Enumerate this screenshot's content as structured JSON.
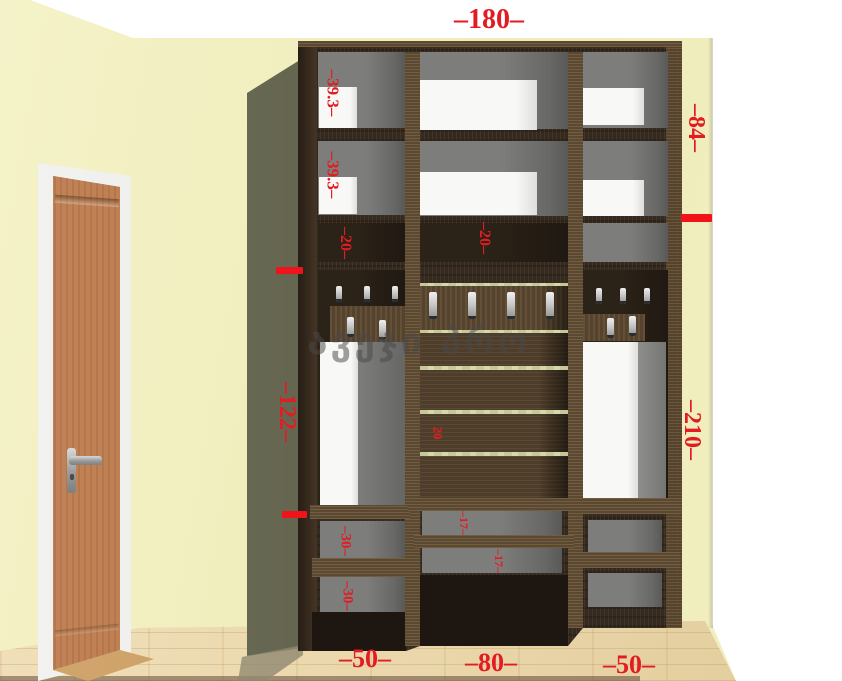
{
  "watermark": {
    "text": "ავეჯი პრო"
  },
  "dimensions": {
    "total_width": "–180–",
    "upper_height": "–84–",
    "right_height": "–210–",
    "left_middle_height": "–122–",
    "left_shelf_top": "–39.3–",
    "left_shelf_second": "–39.3–",
    "left_gap": "–20–",
    "center_gap": "–20–",
    "center_slat_gap": "20",
    "center_shelf_upper": "–17–",
    "center_shelf_lower": "–17–",
    "left_bottom_shelf_upper": "–30–",
    "left_bottom_shelf_lower": "–30–",
    "bottom_left_width": "–50–",
    "bottom_center_width": "–80–",
    "bottom_right_width": "–50–"
  },
  "colors": {
    "dimension_red": "#e31b22",
    "tick_red": "#f2121a",
    "wall_yellow": "#f0edbd",
    "floor_parquet": "#ead8b2",
    "cabinet_wood_dark": "#352a1f",
    "cabinet_wood_mid": "#5b4831",
    "compartment_gray": "#7d7d7b",
    "storage_box_white": "#f8f8f6",
    "door_wood": "#b5774c",
    "slat_green": "#cdd0a2",
    "shadow_olive": "#5c5d49",
    "watermark_gray": "#484848"
  }
}
